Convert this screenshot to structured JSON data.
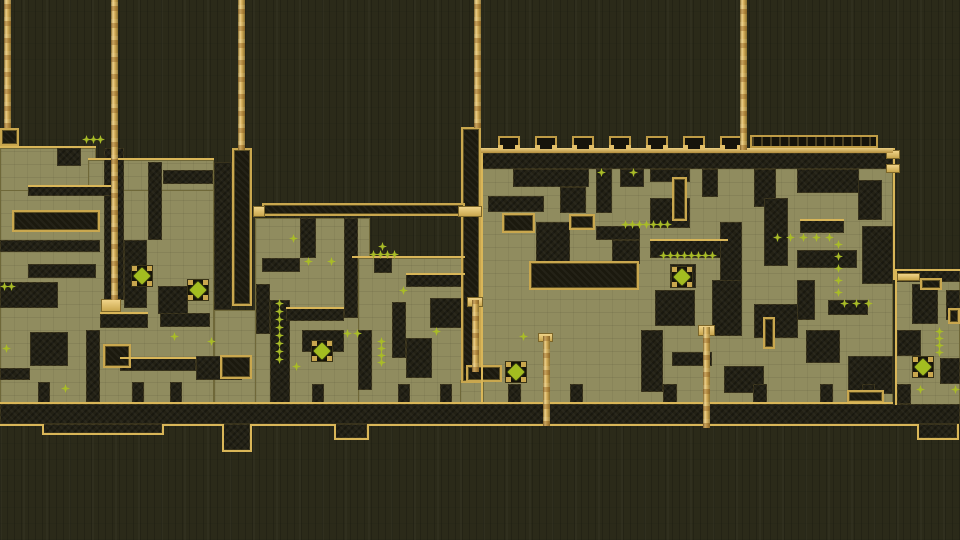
{
  "scene": {
    "width": 960,
    "height": 540,
    "description": "side-view platformer level, olive maze fortresses with hanging gold ropes, crenellated keep, sparkle pickups and diamond gems"
  },
  "palette": {
    "background": "#2b2a19",
    "platform": "#908c5f",
    "wall": "#232115",
    "gold": "#c9a74e",
    "gold_bright": "#d9b658",
    "sparkle": "#a9bc27",
    "gem": "#a3bd20"
  },
  "platforms": [
    [
      0,
      148,
      96,
      44
    ],
    [
      88,
      160,
      126,
      44
    ],
    [
      0,
      190,
      214,
      220
    ],
    [
      214,
      310,
      50,
      100
    ],
    [
      255,
      218,
      115,
      192
    ],
    [
      358,
      258,
      107,
      152
    ],
    [
      481,
      162,
      412,
      243
    ],
    [
      895,
      278,
      65,
      132
    ],
    [
      460,
      380,
      24,
      26
    ]
  ],
  "walls": [
    [
      57,
      148,
      24,
      18
    ],
    [
      104,
      148,
      20,
      152
    ],
    [
      28,
      186,
      84,
      10
    ],
    [
      148,
      162,
      14,
      78
    ],
    [
      163,
      170,
      50,
      14
    ],
    [
      214,
      162,
      18,
      148
    ],
    [
      0,
      240,
      100,
      12
    ],
    [
      124,
      240,
      23,
      68
    ],
    [
      28,
      264,
      68,
      14
    ],
    [
      0,
      282,
      58,
      26
    ],
    [
      158,
      286,
      30,
      28
    ],
    [
      160,
      313,
      50,
      14
    ],
    [
      100,
      314,
      48,
      14
    ],
    [
      30,
      332,
      38,
      34
    ],
    [
      86,
      330,
      14,
      72
    ],
    [
      0,
      368,
      30,
      12
    ],
    [
      120,
      358,
      76,
      13
    ],
    [
      196,
      356,
      46,
      24
    ],
    [
      270,
      300,
      20,
      104
    ],
    [
      300,
      218,
      16,
      40
    ],
    [
      262,
      258,
      38,
      14
    ],
    [
      344,
      218,
      14,
      100
    ],
    [
      256,
      284,
      14,
      50
    ],
    [
      286,
      308,
      58,
      13
    ],
    [
      302,
      330,
      42,
      22
    ],
    [
      374,
      258,
      18,
      15
    ],
    [
      406,
      274,
      59,
      13
    ],
    [
      430,
      298,
      32,
      30
    ],
    [
      392,
      302,
      14,
      56
    ],
    [
      358,
      330,
      14,
      60
    ],
    [
      406,
      338,
      26,
      40
    ],
    [
      481,
      153,
      412,
      16
    ],
    [
      513,
      169,
      76,
      18
    ],
    [
      560,
      187,
      26,
      26
    ],
    [
      596,
      169,
      16,
      44
    ],
    [
      620,
      169,
      24,
      18
    ],
    [
      650,
      169,
      40,
      13
    ],
    [
      702,
      169,
      16,
      28
    ],
    [
      754,
      169,
      22,
      38
    ],
    [
      797,
      169,
      62,
      24
    ],
    [
      858,
      180,
      24,
      40
    ],
    [
      488,
      196,
      56,
      16
    ],
    [
      536,
      222,
      34,
      40
    ],
    [
      596,
      226,
      44,
      14
    ],
    [
      612,
      240,
      28,
      24
    ],
    [
      650,
      198,
      40,
      30
    ],
    [
      650,
      240,
      78,
      18
    ],
    [
      720,
      222,
      22,
      60
    ],
    [
      764,
      198,
      24,
      68
    ],
    [
      800,
      220,
      44,
      13
    ],
    [
      797,
      250,
      60,
      18
    ],
    [
      862,
      226,
      31,
      58
    ],
    [
      655,
      290,
      40,
      36
    ],
    [
      712,
      280,
      30,
      56
    ],
    [
      754,
      304,
      44,
      34
    ],
    [
      797,
      280,
      18,
      40
    ],
    [
      828,
      300,
      40,
      15
    ],
    [
      806,
      330,
      34,
      33
    ],
    [
      848,
      356,
      45,
      38
    ],
    [
      641,
      330,
      22,
      62
    ],
    [
      672,
      352,
      40,
      14
    ],
    [
      724,
      366,
      40,
      27
    ],
    [
      670,
      264,
      26,
      24
    ],
    [
      897,
      270,
      63,
      12
    ],
    [
      912,
      284,
      26,
      40
    ],
    [
      946,
      290,
      14,
      30
    ],
    [
      897,
      330,
      24,
      26
    ],
    [
      940,
      358,
      20,
      26
    ],
    [
      38,
      382,
      12,
      22
    ],
    [
      132,
      382,
      12,
      22
    ],
    [
      170,
      382,
      12,
      22
    ],
    [
      312,
      384,
      12,
      20
    ],
    [
      398,
      384,
      12,
      20
    ],
    [
      440,
      384,
      12,
      20
    ],
    [
      508,
      384,
      13,
      20
    ],
    [
      570,
      384,
      13,
      20
    ],
    [
      663,
      384,
      14,
      20
    ],
    [
      753,
      384,
      14,
      20
    ],
    [
      820,
      384,
      13,
      20
    ],
    [
      862,
      384,
      13,
      20
    ],
    [
      897,
      384,
      14,
      20
    ],
    [
      0,
      404,
      960,
      20
    ],
    [
      42,
      424,
      120,
      9
    ],
    [
      222,
      424,
      28,
      26
    ],
    [
      334,
      424,
      33,
      14
    ],
    [
      917,
      424,
      40,
      14
    ]
  ],
  "gold_boxes": [
    [
      0,
      128,
      19,
      18
    ],
    [
      232,
      148,
      20,
      158
    ],
    [
      461,
      127,
      20,
      256
    ],
    [
      12,
      210,
      88,
      22
    ],
    [
      103,
      344,
      28,
      24
    ],
    [
      502,
      213,
      33,
      20
    ],
    [
      569,
      214,
      26,
      16
    ],
    [
      529,
      261,
      110,
      29
    ],
    [
      672,
      177,
      15,
      44
    ],
    [
      466,
      365,
      36,
      17
    ],
    [
      763,
      317,
      12,
      32
    ],
    [
      920,
      278,
      22,
      12
    ],
    [
      948,
      308,
      12,
      16
    ],
    [
      220,
      355,
      32,
      24
    ],
    [
      262,
      203,
      203,
      13
    ],
    [
      847,
      390,
      37,
      13
    ]
  ],
  "gold_bars": [
    [
      253,
      206,
      12,
      11
    ],
    [
      458,
      206,
      24,
      11
    ],
    [
      101,
      299,
      20,
      13
    ],
    [
      467,
      297,
      16,
      10
    ],
    [
      698,
      325,
      17,
      11
    ],
    [
      538,
      333,
      15,
      9
    ],
    [
      897,
      273,
      23,
      8
    ],
    [
      886,
      150,
      14,
      9
    ],
    [
      886,
      164,
      14,
      9
    ]
  ],
  "hlines": [
    [
      0,
      146,
      96
    ],
    [
      88,
      158,
      126
    ],
    [
      352,
      256,
      113
    ],
    [
      897,
      269,
      63
    ],
    [
      28,
      185,
      84
    ],
    [
      100,
      312,
      48
    ],
    [
      120,
      357,
      76
    ],
    [
      286,
      307,
      58
    ],
    [
      406,
      273,
      59
    ],
    [
      800,
      219,
      44
    ],
    [
      650,
      239,
      78
    ],
    [
      0,
      402,
      893
    ],
    [
      0,
      424,
      44
    ],
    [
      42,
      433,
      122
    ],
    [
      162,
      424,
      62
    ],
    [
      222,
      450,
      30
    ],
    [
      250,
      424,
      86
    ],
    [
      334,
      438,
      35
    ],
    [
      367,
      424,
      552
    ],
    [
      917,
      438,
      42
    ]
  ],
  "vlines": [
    [
      481,
      148,
      256
    ],
    [
      893,
      148,
      132
    ],
    [
      895,
      269,
      136
    ],
    [
      42,
      424,
      10
    ],
    [
      162,
      424,
      10
    ],
    [
      222,
      424,
      27
    ],
    [
      250,
      424,
      27
    ],
    [
      334,
      424,
      15
    ],
    [
      367,
      424,
      15
    ],
    [
      917,
      424,
      15
    ],
    [
      957,
      424,
      15
    ]
  ],
  "rail": [
    481,
    148,
    412,
    5
  ],
  "merlons": [
    498,
    535,
    572,
    609,
    646,
    683,
    720
  ],
  "merlon_y": 136,
  "merlon_wall": [
    750,
    135,
    128,
    13
  ],
  "pillars": [
    [
      4,
      0,
      128
    ],
    [
      111,
      0,
      300
    ],
    [
      238,
      0,
      150
    ],
    [
      474,
      0,
      128
    ],
    [
      740,
      0,
      150
    ],
    [
      472,
      300,
      72
    ],
    [
      703,
      327,
      101
    ],
    [
      543,
      336,
      90
    ]
  ],
  "sparkles": [
    [
      86,
      139
    ],
    [
      93,
      139
    ],
    [
      100,
      139
    ],
    [
      4,
      286
    ],
    [
      11,
      286
    ],
    [
      6,
      348
    ],
    [
      65,
      388
    ],
    [
      174,
      336
    ],
    [
      211,
      341
    ],
    [
      293,
      238
    ],
    [
      308,
      261
    ],
    [
      331,
      261
    ],
    [
      279,
      303
    ],
    [
      279,
      311
    ],
    [
      279,
      319
    ],
    [
      279,
      327
    ],
    [
      279,
      335
    ],
    [
      279,
      343
    ],
    [
      279,
      351
    ],
    [
      279,
      359
    ],
    [
      296,
      366
    ],
    [
      382,
      246
    ],
    [
      373,
      254
    ],
    [
      380,
      254
    ],
    [
      387,
      254
    ],
    [
      394,
      254
    ],
    [
      403,
      290
    ],
    [
      381,
      341
    ],
    [
      381,
      348
    ],
    [
      381,
      355
    ],
    [
      381,
      362
    ],
    [
      347,
      333
    ],
    [
      357,
      333
    ],
    [
      436,
      331
    ],
    [
      523,
      336
    ],
    [
      601,
      172
    ],
    [
      633,
      172
    ],
    [
      625,
      224
    ],
    [
      632,
      224
    ],
    [
      639,
      224
    ],
    [
      646,
      224
    ],
    [
      653,
      224
    ],
    [
      660,
      224
    ],
    [
      667,
      224
    ],
    [
      663,
      255
    ],
    [
      670,
      255
    ],
    [
      677,
      255
    ],
    [
      684,
      255
    ],
    [
      691,
      255
    ],
    [
      698,
      255
    ],
    [
      705,
      255
    ],
    [
      712,
      255
    ],
    [
      777,
      237
    ],
    [
      790,
      237
    ],
    [
      803,
      237
    ],
    [
      816,
      237
    ],
    [
      829,
      237
    ],
    [
      838,
      244
    ],
    [
      838,
      256
    ],
    [
      838,
      268
    ],
    [
      838,
      280
    ],
    [
      838,
      292
    ],
    [
      844,
      303
    ],
    [
      856,
      303
    ],
    [
      868,
      303
    ],
    [
      939,
      331
    ],
    [
      939,
      338
    ],
    [
      939,
      345
    ],
    [
      939,
      352
    ],
    [
      920,
      389
    ],
    [
      955,
      389
    ]
  ],
  "diamonds": [
    [
      142,
      276
    ],
    [
      198,
      290
    ],
    [
      322,
      351
    ],
    [
      516,
      372
    ],
    [
      682,
      277
    ],
    [
      923,
      367
    ]
  ]
}
